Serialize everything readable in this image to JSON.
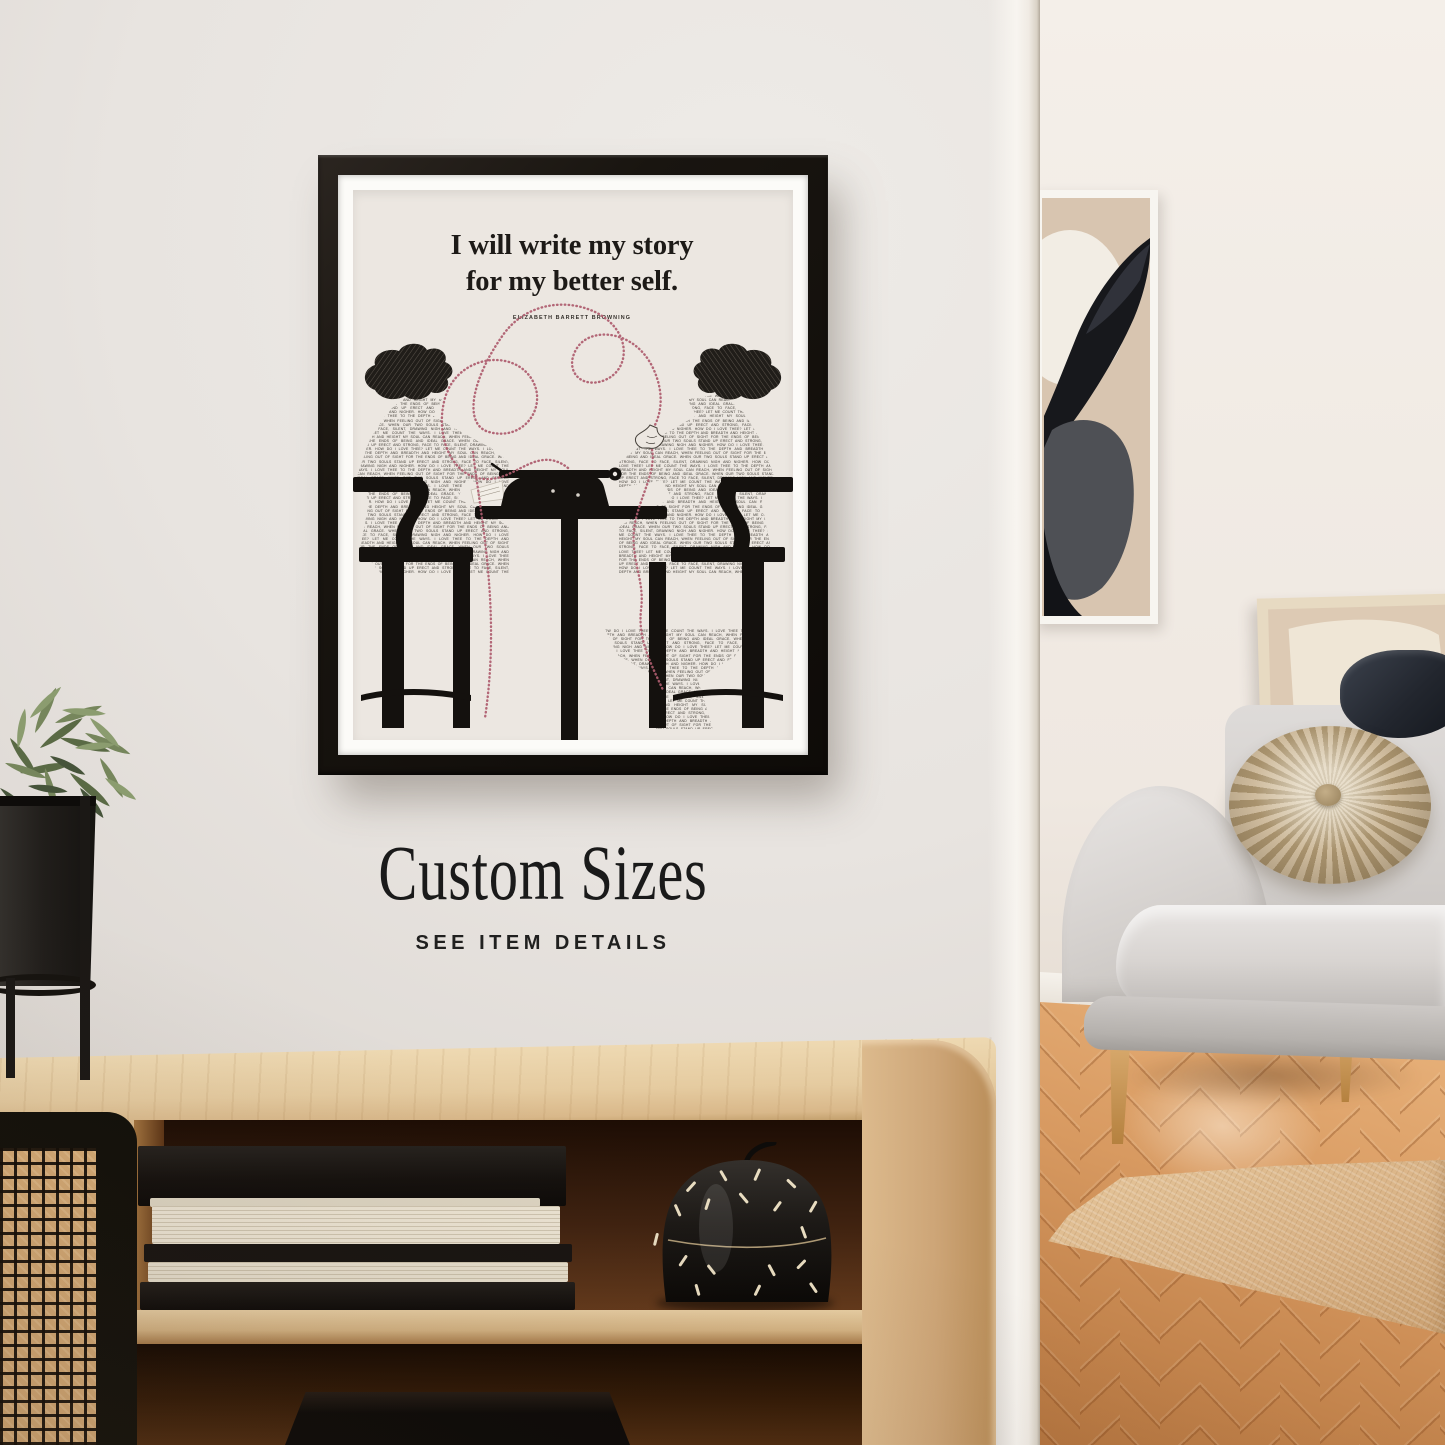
{
  "scene": {
    "kind": "interior product mockup photo",
    "objects": [
      "framed-quote-poster",
      "wall-art-top",
      "wall-art-leaning",
      "grey-sofa",
      "round-pleated-pillow",
      "dark-pillow",
      "jute-rug",
      "herringbone-floor",
      "wooden-sideboard",
      "cane-door",
      "book-stack",
      "speckled-candle-jar",
      "potted-plant"
    ]
  },
  "poster": {
    "quote_line1": "I will write my story",
    "quote_line2": "for my better self.",
    "attribution": "ELIZABETH BARRETT BROWNING",
    "fill_text": "HOW DO I LOVE THEE? LET ME COUNT THE WAYS. I LOVE THEE TO THE DEPTH AND BREADTH AND HEIGHT MY SOUL CAN REACH, WHEN FEELING OUT OF SIGHT FOR THE ENDS OF BEING AND IDEAL GRACE. WHEN OUR TWO SOULS STAND UP ERECT AND STRONG, FACE TO FACE, SILENT, DRAWING NIGH AND NIGHER. "
  },
  "wall_promo": {
    "headline": "Custom Sizes",
    "subline": "SEE ITEM DETAILS"
  },
  "palette": {
    "thread_pink": "#ae5c6e",
    "poster_cream": "#ece7e1",
    "frame_black": "#15110d",
    "front_wall": "#e6e2dd",
    "wood_light": "#e3c79c",
    "sofa_grey": "#d6d3d0",
    "pillow_tan": "#c0ad8d",
    "floor_oak": "#d2925b",
    "rug_jute": "#dcba8e",
    "art_beige": "#d8c5b0",
    "plant_green": "#6d7c55"
  }
}
